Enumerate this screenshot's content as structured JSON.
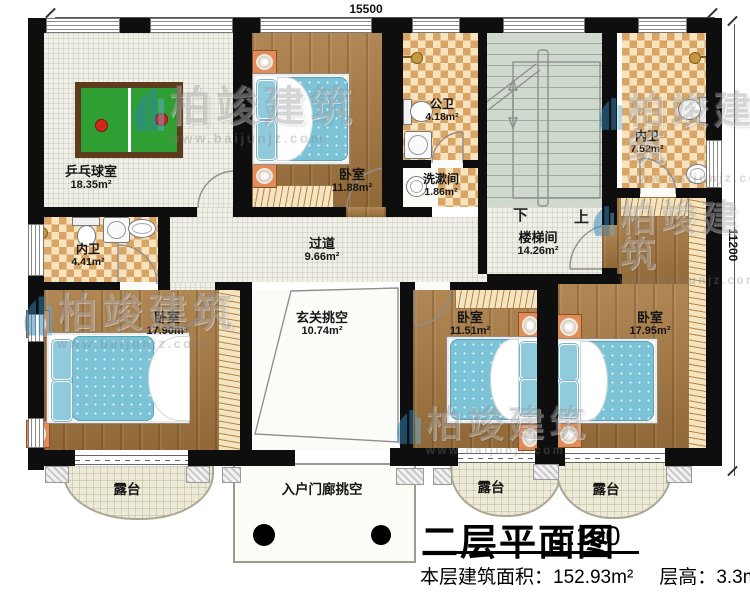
{
  "dimensions": {
    "width_mm": "15500",
    "height_mm": "11200"
  },
  "rooms": {
    "pingpong": {
      "name": "乒乓球室",
      "area": "18.35m²"
    },
    "bedroom_top": {
      "name": "卧室",
      "area": "11.88m²"
    },
    "public_bath": {
      "name": "公卫",
      "area": "4.18m²"
    },
    "washroom": {
      "name": "洗漱间",
      "area": "1.86m²"
    },
    "stairwell": {
      "name": "楼梯间",
      "area": "14.26m²"
    },
    "bath_right": {
      "name": "内卫",
      "area": "7.52m²"
    },
    "corridor": {
      "name": "过道",
      "area": "9.66m²"
    },
    "bath_left": {
      "name": "内卫",
      "area": "4.41m²"
    },
    "bedroom_bl": {
      "name": "卧室",
      "area": "17.90m²"
    },
    "foyer_void": {
      "name": "玄关挑空",
      "area": "10.74m²"
    },
    "bedroom_bc": {
      "name": "卧室",
      "area": "11.51m²"
    },
    "bedroom_br": {
      "name": "卧室",
      "area": "17.95m²"
    }
  },
  "outdoor": {
    "terrace_left": {
      "name": "露台"
    },
    "terrace_center": {
      "name": "露台"
    },
    "terrace_right": {
      "name": "露台"
    },
    "porch": {
      "name": "入户门廊挑空"
    }
  },
  "stairs": {
    "down": "下",
    "up": "上"
  },
  "title": {
    "main": "二层平面图",
    "scale": "1:100",
    "area_label": "本层建筑面积：",
    "area_value": "152.93m²",
    "height_label": "层高：",
    "height_value": "3.3m"
  },
  "watermark": {
    "brand": "柏竣建筑",
    "url": "www.baijunjz.com"
  },
  "colors": {
    "wall": "#0e0e0e",
    "wood": "#a87a41",
    "tile": "#f0efe7",
    "checker_light": "#f7e3bd",
    "checker_dark": "#d9a567",
    "stair": "#cfd9cd",
    "mattress": "#7cc3d8",
    "table_green": "#2f9e33",
    "logo_blue": "#2e86b9"
  }
}
